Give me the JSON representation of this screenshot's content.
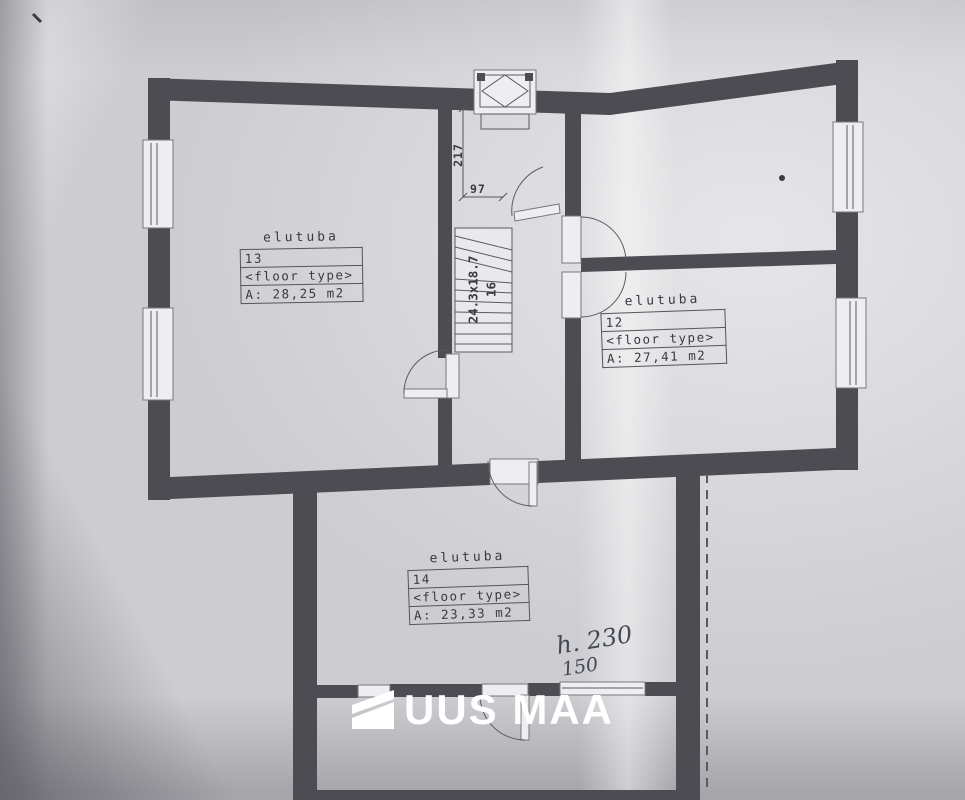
{
  "rooms": [
    {
      "name": "elutuba",
      "number": "13",
      "floor_type": "<floor type>",
      "area": "A: 28,25 m2"
    },
    {
      "name": "elutuba",
      "number": "12",
      "floor_type": "<floor type>",
      "area": "A: 27,41 m2"
    },
    {
      "name": "elutuba",
      "number": "14",
      "floor_type": "<floor type>",
      "area": "A: 23,33 m2"
    }
  ],
  "dimensions": {
    "hall_length": "217",
    "opening_width": "97"
  },
  "stairs": {
    "size_label": "24.3x18.7",
    "steps": "16"
  },
  "annotations": {
    "line1": "h. 230",
    "line2": "150"
  },
  "logo": {
    "text": "UUS MAA"
  },
  "colors": {
    "wall": "#4c4c52",
    "paper": "#cdcdd1",
    "line": "#5a5a60",
    "logo": "#ffffff",
    "ink": "#343a46"
  }
}
